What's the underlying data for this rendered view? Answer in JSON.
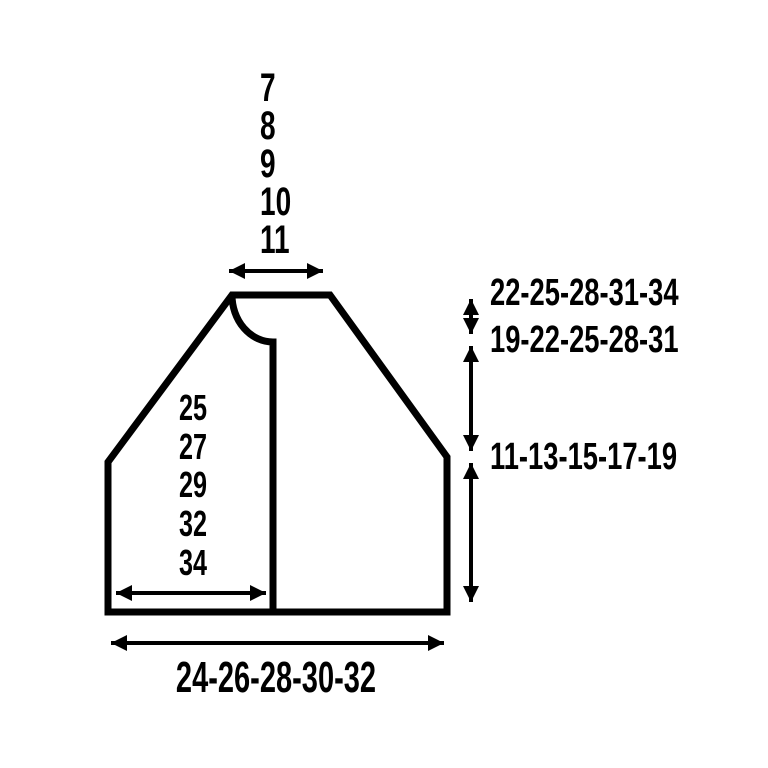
{
  "diagram": {
    "type": "garment-measurement-schematic",
    "background_color": "#ffffff",
    "line_color": "#000000",
    "top_width_sizes": [
      "7",
      "8",
      "9",
      "10",
      "11"
    ],
    "inner_width_sizes": [
      "25",
      "27",
      "29",
      "32",
      "34"
    ],
    "right_measurements": [
      "22-25-28-31-34",
      "19-22-25-28-31",
      "11-13-15-17-19"
    ],
    "bottom_width_sizes": "24-26-28-30-32"
  }
}
